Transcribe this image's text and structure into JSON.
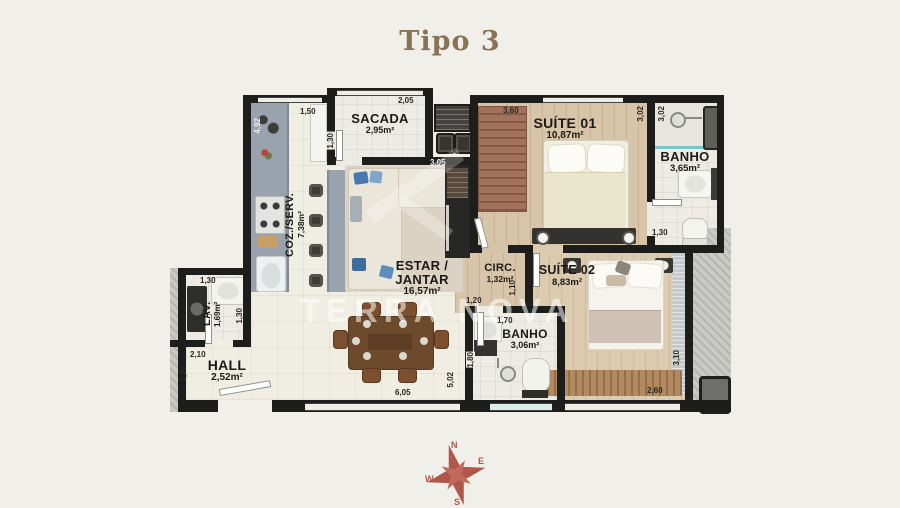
{
  "page": {
    "title": "Tipo 3",
    "background": "#f0efe9",
    "title_color": "#8a7254",
    "wall_color": "#1d1d1b",
    "watermark": "TERRA NOVA"
  },
  "rooms": {
    "sacada": {
      "name": "SACADA",
      "area": "2,95m²"
    },
    "coz": {
      "name": "COZ./SERV.",
      "area": "7,38m²"
    },
    "suite01": {
      "name": "SUÍTE 01",
      "area": "10,87m²"
    },
    "banho01": {
      "name": "BANHO",
      "area": "3,65m²"
    },
    "estar": {
      "name": "ESTAR / JANTAR",
      "area": "16,57m²"
    },
    "circ": {
      "name": "CIRC.",
      "area": "1,32m²"
    },
    "suite02": {
      "name": "SUÍTE 02",
      "area": "8,83m²"
    },
    "banho02": {
      "name": "BANHO",
      "area": "3,06m²"
    },
    "lav": {
      "name": "LAV.",
      "area": "1,69m²"
    },
    "hall": {
      "name": "HALL",
      "area": "2,52m²"
    }
  },
  "dims": {
    "sacada_w": "2,05",
    "sacada_h": "1,30",
    "coz_top": "1,50",
    "coz_left": "4,92",
    "shaft_w": "3,05",
    "suite01_w": "3,60",
    "suite01_h": "3,02",
    "banho01_h": "3,02",
    "banho01_w": "1,30",
    "circ_w": "1,20",
    "circ_h": "1,10",
    "banho02_w": "1,70",
    "banho02_h": "1,80",
    "estar_h": "5,02",
    "lav_w": "1,30",
    "lav_h": "1,30",
    "hall_w": "2,10",
    "hall_h": "1,20",
    "hall_bottom": "6,05",
    "suite02_h": "3,10",
    "suite02_w": "2,60"
  },
  "compass": {
    "n": "N",
    "e": "E",
    "s": "S",
    "w": "W",
    "color": "#b0574a"
  }
}
